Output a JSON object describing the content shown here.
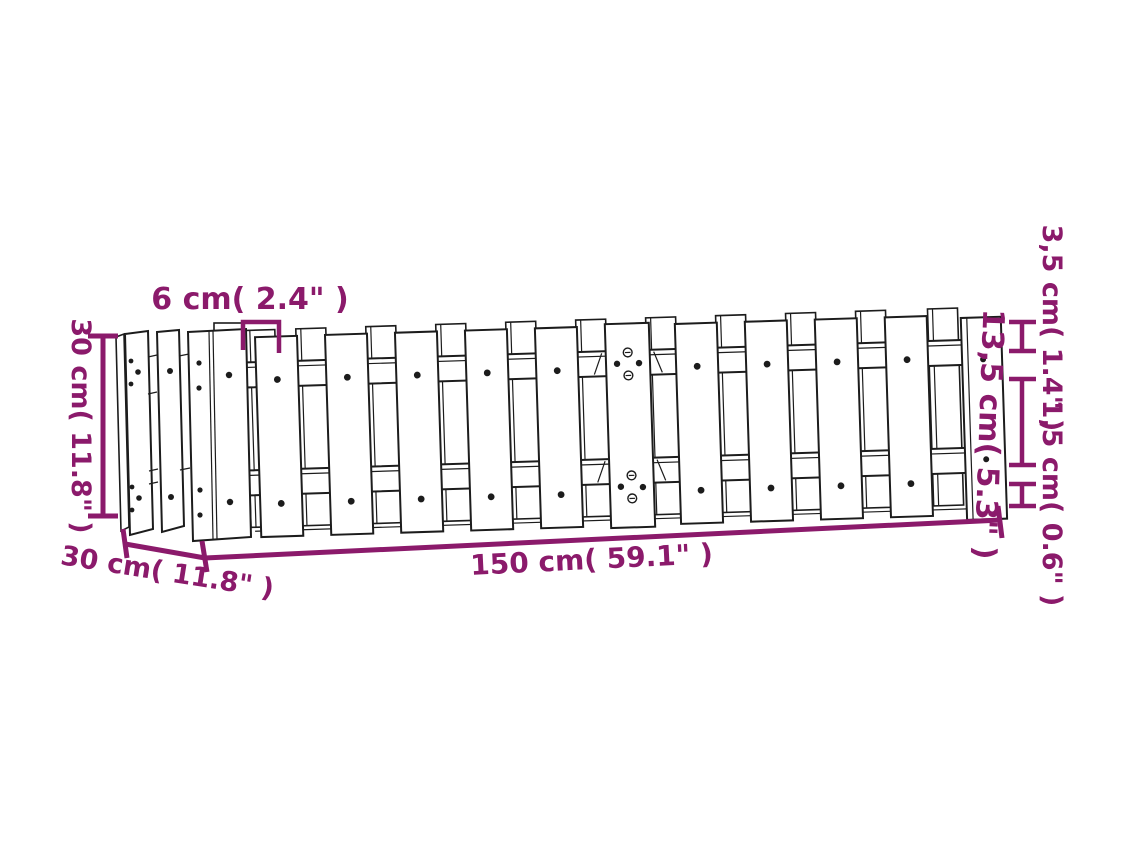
{
  "diagram": {
    "title": "raised garden bed with picket fence design - dimension drawing",
    "dimensions": {
      "height": "30 cm( 11.8\" )",
      "picket_gap": "6 cm( 2.4\" )",
      "depth": "30 cm( 11.8\" )",
      "length": "150 cm( 59.1\" )",
      "slat_top": "3,5 cm( 1.4\" )",
      "picket_height": "13,5 cm( 5.3\" )",
      "slat_bottom": "1,5 cm( 0.6\" )"
    },
    "colors": {
      "dimension_accent": "#8b1a6b",
      "drawing_line": "#1c1c1c",
      "background": "#ffffff"
    }
  }
}
